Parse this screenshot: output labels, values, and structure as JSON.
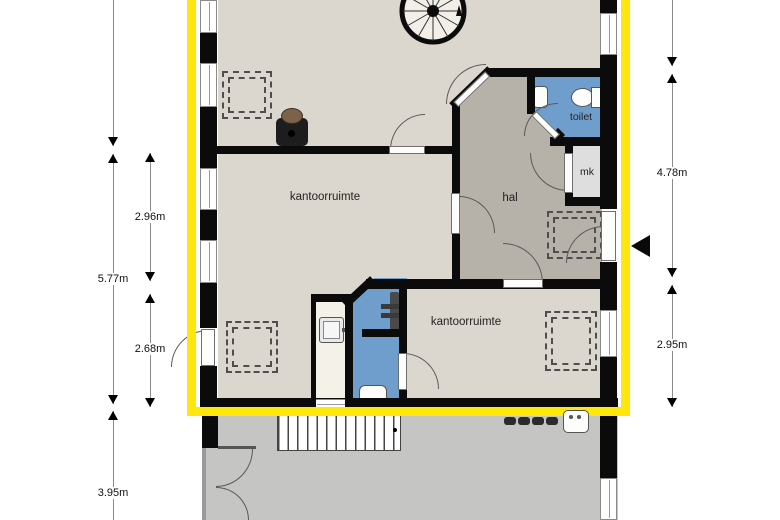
{
  "plan": {
    "title": "floor plan - first floor office level",
    "rooms": {
      "office1": "kantoorruimte",
      "office2": "kantoorruimte",
      "hall": "hal",
      "toilet": "toilet",
      "meter_closet": "mk"
    },
    "dimensions": {
      "left_outer": [
        "5.77m",
        "3.95m"
      ],
      "left_inner": [
        "2.96m",
        "2.68m"
      ],
      "right": [
        "4.78m",
        "2.95m"
      ]
    },
    "colors": {
      "highlight_outline": "#ffe60d",
      "office_floor": "#dcd7ce",
      "hall_floor": "#b6b1a9",
      "wet_room_floor": "#6f9ecd",
      "meter_closet_floor": "#dedede",
      "small_room_floor": "#f4f1e9",
      "lower_level_floor": "#c5c5c4",
      "wall": "#0b0b0b"
    },
    "icons": {
      "spiral_staircase": "circle-with-radial-spokes",
      "wood_stove": "dark-box-with-brown-dome",
      "toilet_fixture": "oval-bowl-with-cistern",
      "hand_sink": "small-rounded-square",
      "shower_tray": "rounded-square-with-drain",
      "radiator": "vertical-bar-with-cross-arms",
      "straight_stairs": "striped-stair-run",
      "roof_window": "double-dashed-rectangle",
      "entrance_arrow": "solid-left-pointing-triangle",
      "cooktop_burners": "row-of-dark-knobs",
      "kitchen_sink": "rounded-square-with-two-dots"
    }
  }
}
